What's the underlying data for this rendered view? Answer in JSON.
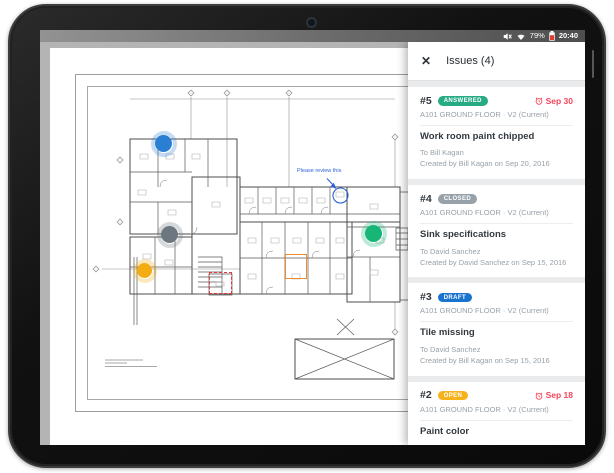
{
  "device": {
    "status_bar": {
      "battery_percent": "79%",
      "time": "20:40",
      "icons": [
        "mute-icon",
        "wifi-icon",
        "battery-icon"
      ]
    }
  },
  "panel": {
    "close_label": "✕",
    "title": "Issues (4)"
  },
  "issues": [
    {
      "number": "#5",
      "status": "ANSWERED",
      "status_color": "#27ab83",
      "due_date": "Sep 30",
      "due_color": "#f4455a",
      "plan_label": "A101 GROUND FLOOR · V2 (Current)",
      "title": "Work room paint chipped",
      "assignee": "To Bill Kagan",
      "created": "Created by Bill Kagan on Sep 20, 2016"
    },
    {
      "number": "#4",
      "status": "CLOSED",
      "status_color": "#97a1aa",
      "plan_label": "A101 GROUND FLOOR · V2 (Current)",
      "title": "Sink specifications",
      "assignee": "To David Sanchez",
      "created": "Created by David Sanchez on Sep 15, 2016"
    },
    {
      "number": "#3",
      "status": "DRAFT",
      "status_color": "#1a73cf",
      "plan_label": "A101 GROUND FLOOR · V2 (Current)",
      "title": "Tile missing",
      "assignee": "To David Sanchez",
      "created": "Created by Bill Kagan on Sep 15, 2016"
    },
    {
      "number": "#2",
      "status": "OPEN",
      "status_color": "#f6b21b",
      "due_date": "Sep 18",
      "due_color": "#f4455a",
      "plan_label": "A101 GROUND FLOOR · V2 (Current)",
      "title": "Paint color"
    }
  ],
  "plan": {
    "annotation": {
      "text": "Please review this",
      "color": "#2f62d8"
    },
    "markers": [
      {
        "name": "blue-issue-marker",
        "color": "#2b7fd2"
      },
      {
        "name": "gray-issue-marker",
        "color": "#6d7780"
      },
      {
        "name": "green-issue-marker",
        "color": "#17b576"
      },
      {
        "name": "yellow-issue-marker",
        "color": "#f3ac13"
      }
    ],
    "boxes": [
      {
        "name": "orange-highlight-box",
        "color": "#ef8d2a"
      },
      {
        "name": "red-dashed-box",
        "color": "#e03a3a"
      }
    ]
  }
}
